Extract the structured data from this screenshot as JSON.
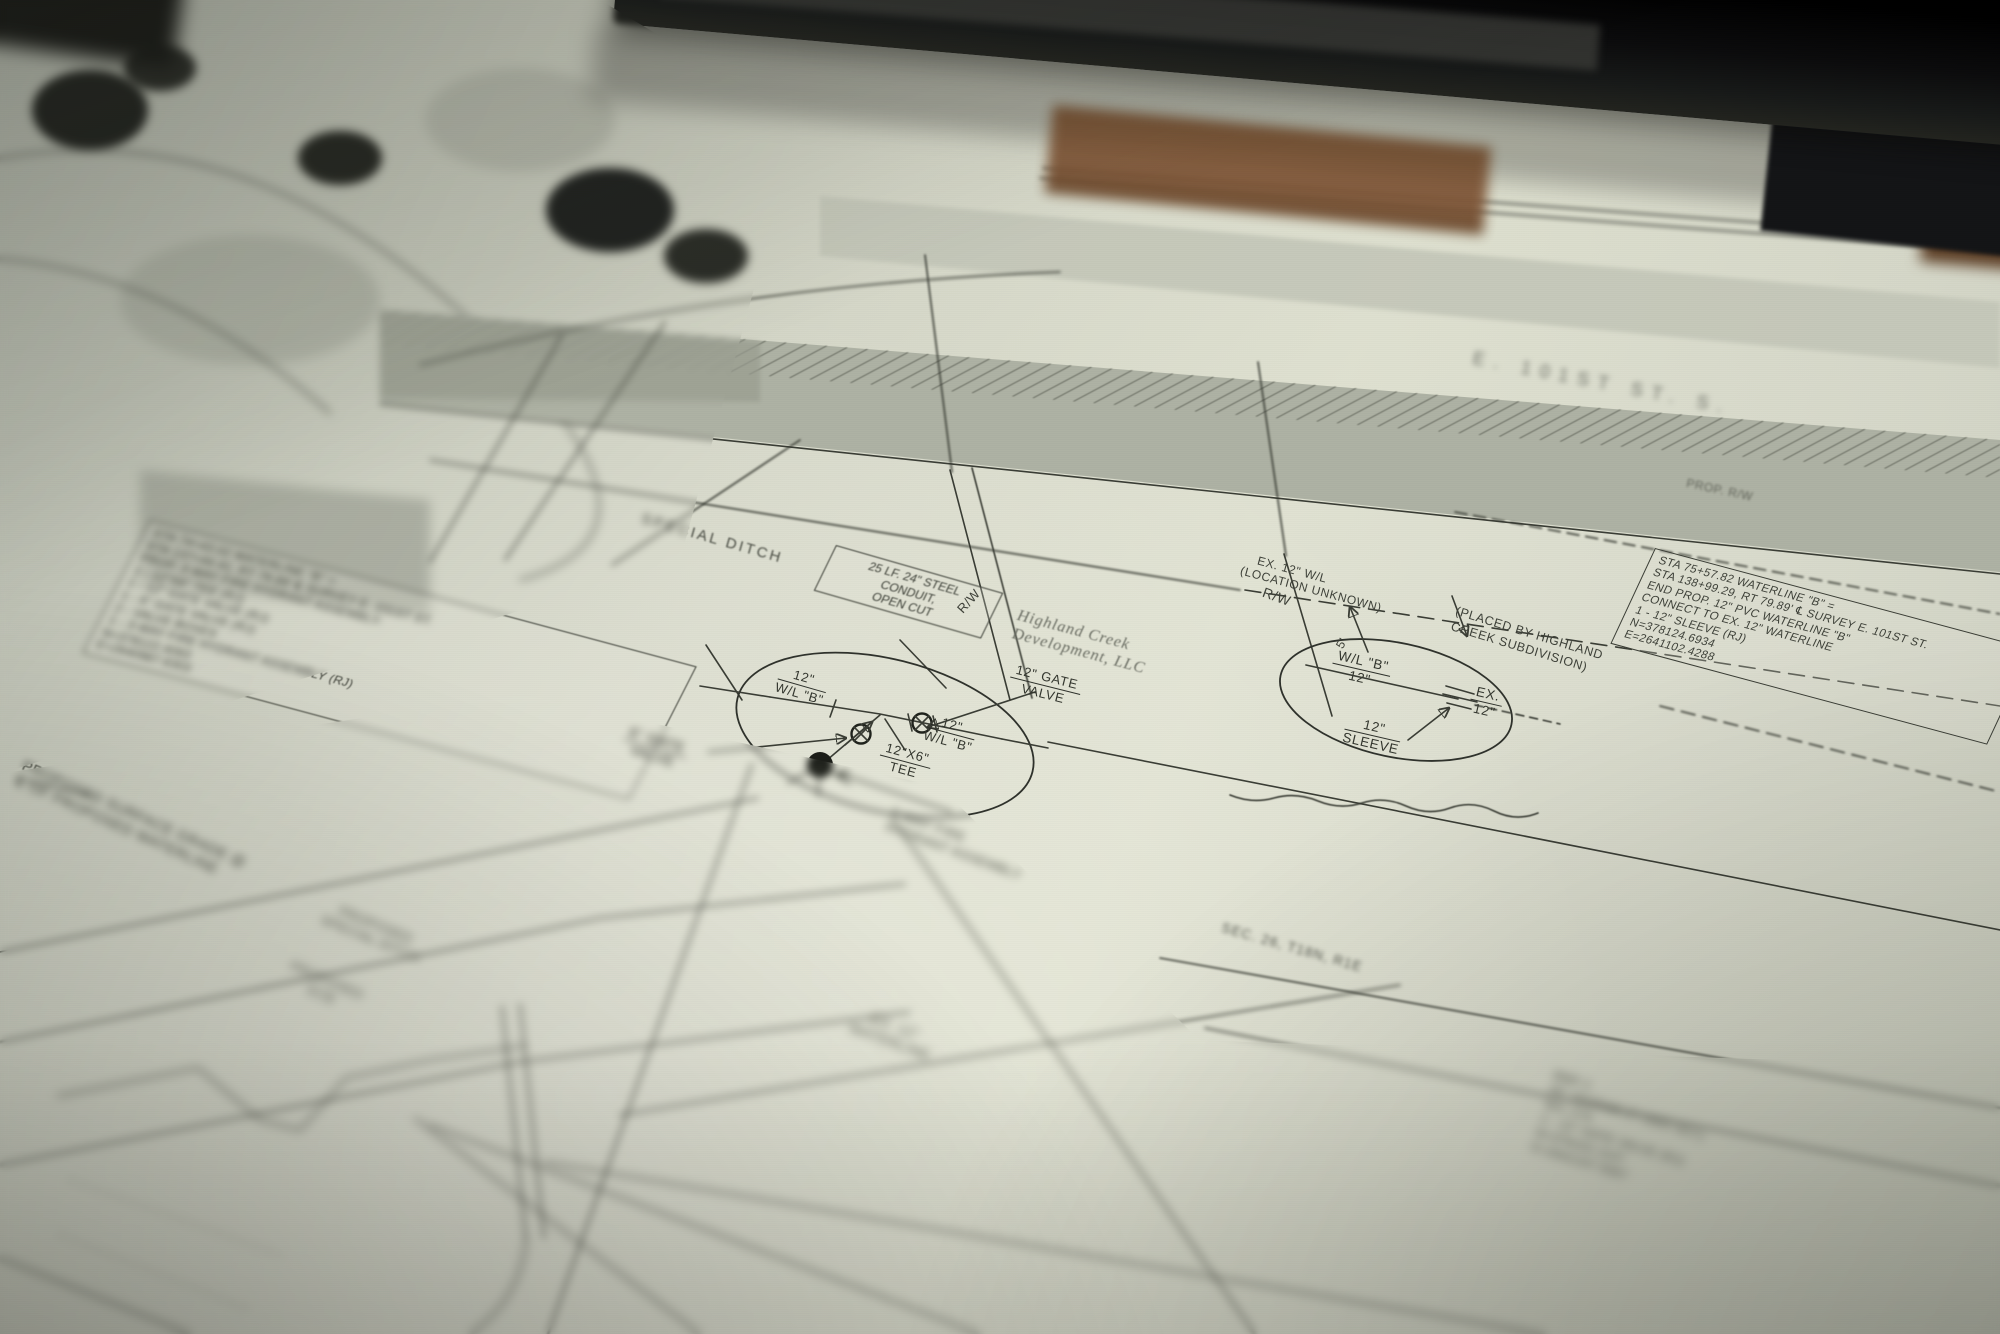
{
  "colors": {
    "paper": "#d3d5c6",
    "ink": "#3a3d35",
    "road_band": "#aeb2a4",
    "laptop": "#0c0c0d",
    "wood": "#82593a"
  },
  "callout_left": {
    "lines": [
      "STA 74+43.02 WATERLINE \"B\" =",
      "STA 137+44.41, RT 79.89' ℄ SURVEY E. 101ST ST.",
      "PROP. 3-WAY FIRE HYDRANT ASSEMBLY:",
      "1 - 12\"X6\" TEE (RJ)",
      "1 - 12\" GATE VALVE (RJ)",
      "1 - 6\" GATE VALVE (RJ)",
      "2 - VALVE BOXES",
      "1 - 3-WAY FIRE HYDRANT ASSEMBLY (RJ)",
      "N=378122.4093",
      "E=2640987.6303"
    ]
  },
  "callout_right": {
    "lines": [
      "STA 75+57.82 WATERLINE \"B\" =",
      "STA 138+99.29, RT 79.89' ℄ SURVEY E. 101ST ST.",
      "END PROP. 12\" PVC WATERLINE \"B\"",
      "CONNECT TO EX. 12\" WATERLINE",
      "1 - 12\" SLEEVE (RJ)",
      "N=378124.6934",
      "E=2641102.4288"
    ]
  },
  "conduit_note": {
    "l1": "25 LF. 24\" STEEL",
    "l2": "CONDUIT,",
    "l3": "OPEN CUT"
  },
  "labels": {
    "special_ditch": "SPECIAL DITCH",
    "rw_a": "R/W",
    "rw_b": "R/W",
    "prop_rw": "PROP. R/W",
    "dim_5ft": "5'",
    "road_heading": "E. 101ST ST. S.",
    "highland_l1": "Highland Creek",
    "highland_l2": "Development, LLC",
    "ex12_l1": "EX. 12\" W/L",
    "ex12_l2": "(LOCATION UNKNOWN)",
    "placed_l1": "(PLACED BY HIGHLAND",
    "placed_l2": "CREEK SUBDIVISION)",
    "c1_left_top": "12\"",
    "c1_left_bot": "W/L \"B\"",
    "c1_right_top": "12\"",
    "c1_right_bot": "W/L \"B\"",
    "c1_tee_top": "12\"X6\"",
    "c1_tee_bot": "TEE",
    "gate12_top": "12\" GATE",
    "gate12_bot": "VALVE",
    "gate6_top": "6\" GATE",
    "gate6_bot": "VALVE",
    "hyd_l1": "3-WAY FIRE",
    "hyd_l2": "HYDRANT ASSEMBLY",
    "c2_wl_top": "W/L \"B\"",
    "c2_wl_bot": "12\"",
    "c2_ex_top": "EX.",
    "c2_ex_bot": "12\"",
    "c2_sleeve_top": "12\"",
    "c2_sleeve_bot": "SLEEVE",
    "grade_l1": "PROPOSED SURFACE GRADE @",
    "grade_l2": "℄ OF PROPOSED WATERLINE",
    "pditch_l1": "PROPOSED",
    "pditch_l2": "SPECIAL DITCH",
    "pecb_l1": "PROPOSED",
    "pecb_l2": "ECB",
    "exwl_l1": "EX. 12\"",
    "exwl_l2": "WATERLINE",
    "section": "SEC. 26, T18N, R1E"
  },
  "illegible_block": {
    "lines": [
      "BMP 2",
      "48\" INGRAM 27 (SEE KEY)",
      "W/L 27A",
      "1 - 12\" GATE VALVE (RJ)",
      "N=378102.1147",
      "E=2641247.5567"
    ]
  }
}
